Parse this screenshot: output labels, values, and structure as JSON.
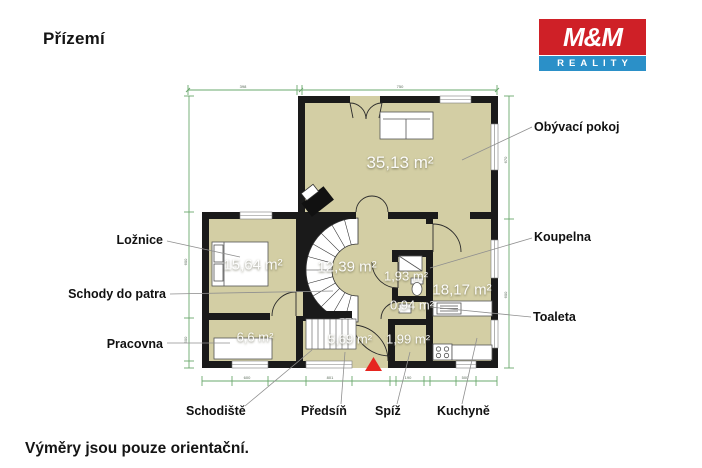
{
  "page": {
    "title": "Přízemí",
    "footnote": "Výměry jsou pouze orientační."
  },
  "logo": {
    "top": "M&M",
    "bottom": "REALITY",
    "red": "#cf2027",
    "blue": "#2b90c8"
  },
  "plan": {
    "colors": {
      "floor": "#d3cea4",
      "wall": "#1a1a1a",
      "dimension_line": "#6aa86d",
      "leader_line": "#8f8f8f",
      "entrance_marker": "#e6251f"
    },
    "rooms": [
      {
        "label": "Obývací pokoj",
        "area": "35,13 m²"
      },
      {
        "label": "Ložnice",
        "area": "15,64 m²"
      },
      {
        "label": "Schody do patra",
        "area": "12,39 m²"
      },
      {
        "label": "Koupelna",
        "area": "1,93 m²"
      },
      {
        "label": "Toaleta",
        "area": "0,94 m²"
      },
      {
        "label": "Kuchyně",
        "area": "18,17 m²"
      },
      {
        "label": "Pracovna",
        "area": "6,6 m²"
      },
      {
        "label": "Předsíň",
        "area": "5,69 m²"
      },
      {
        "label": "Spíž",
        "area": "1,99 m²"
      },
      {
        "label": "Schodiště",
        "area": ""
      }
    ],
    "dimensions": {
      "top": [
        "398",
        "750"
      ],
      "bottom": [
        "600",
        "801",
        "190",
        "500"
      ],
      "left": [
        "600",
        "500"
      ],
      "right": [
        "670",
        "600"
      ]
    }
  }
}
